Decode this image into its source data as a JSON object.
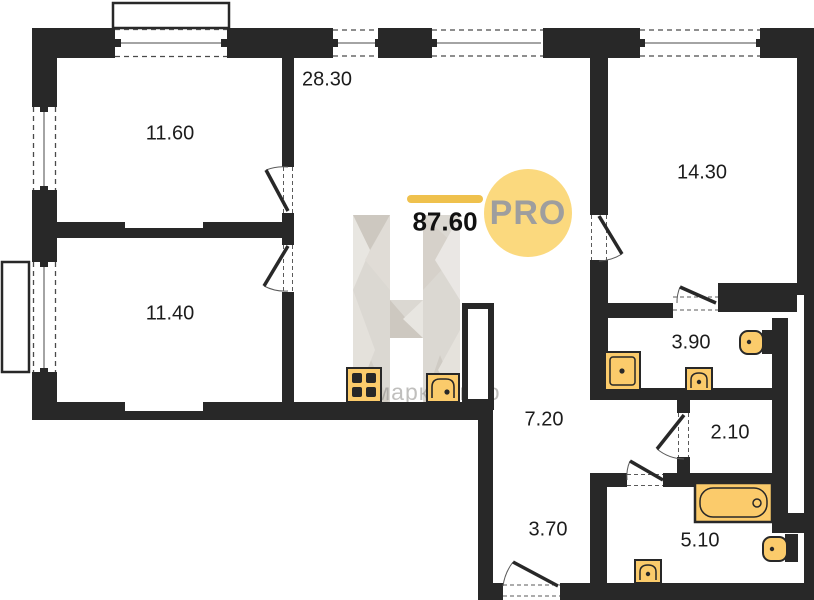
{
  "plan": {
    "total_area": "87.60",
    "logo": {
      "text": "PRO"
    },
    "watermark": {
      "letter": "Н",
      "text": "н-маркет.про"
    },
    "rooms": [
      {
        "id": "bedroom-1",
        "area": "11.60"
      },
      {
        "id": "living-kitchen",
        "area": "28.30"
      },
      {
        "id": "bedroom-2",
        "area": "14.30"
      },
      {
        "id": "bedroom-3",
        "area": "11.40"
      },
      {
        "id": "bathroom-ensuite",
        "area": "3.90"
      },
      {
        "id": "hallway",
        "area": "7.20"
      },
      {
        "id": "storage",
        "area": "2.10"
      },
      {
        "id": "entry-hall",
        "area": "3.70"
      },
      {
        "id": "bathroom-main",
        "area": "5.10"
      }
    ],
    "fixtures": [
      "stove",
      "kitchen-sink",
      "shower",
      "washbasin",
      "toilet",
      "bathtub"
    ],
    "colors": {
      "wall": "#282828",
      "fixture_fill": "#FBCB6B",
      "logo_circle": "#FBD97E",
      "accent_bar": "#EFC14D",
      "watermark_gray": "#D9D5CF"
    }
  }
}
